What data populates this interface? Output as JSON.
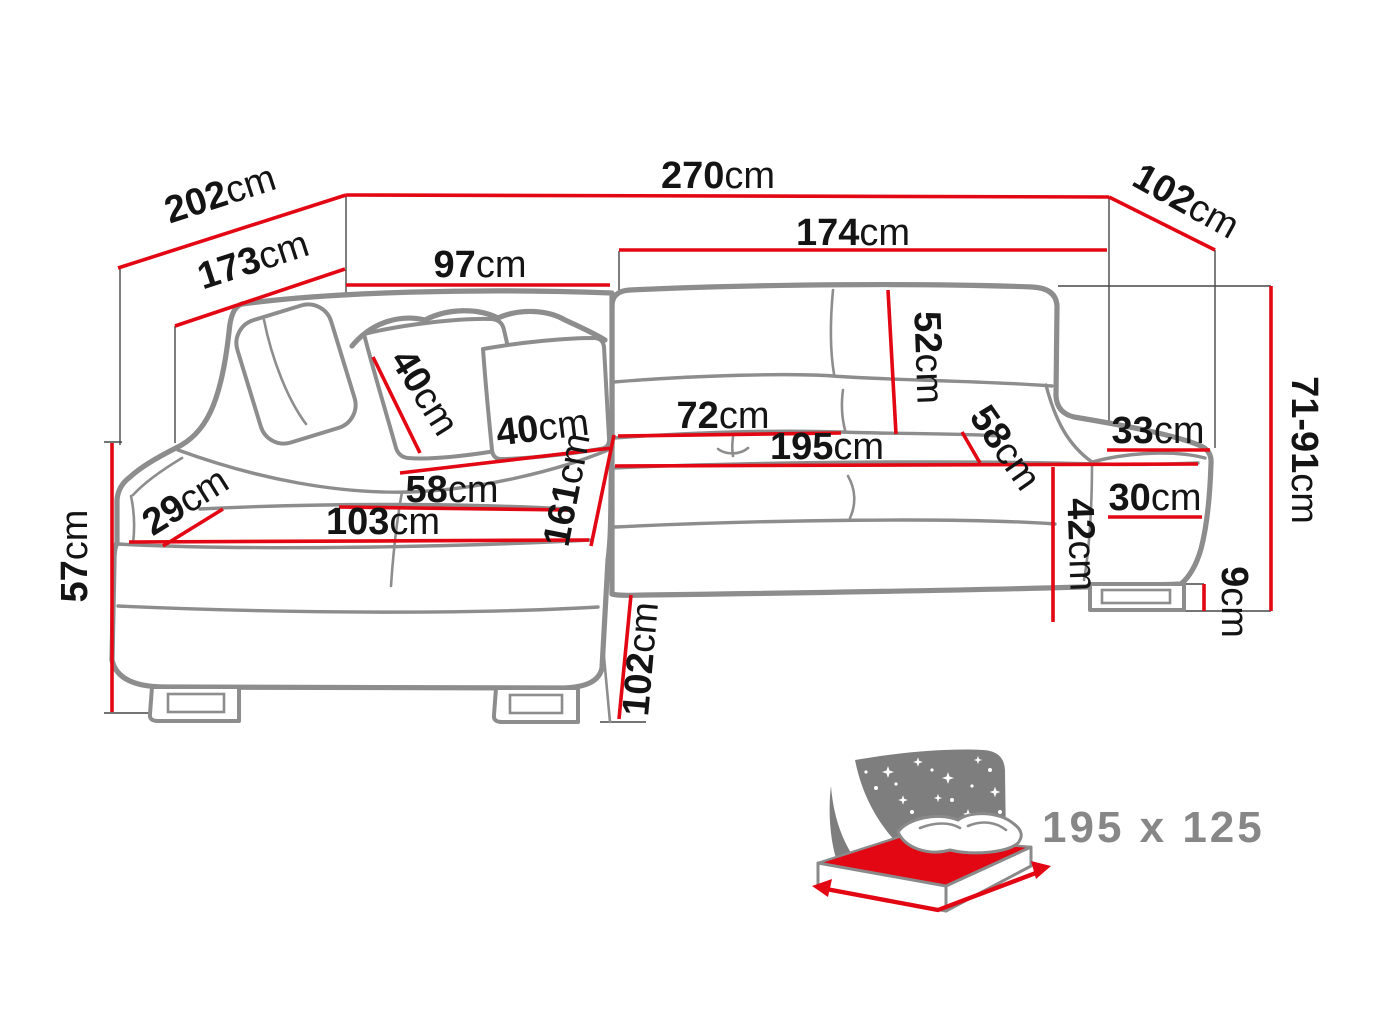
{
  "diagram": {
    "type": "corner-sofa-bed dimension drawing",
    "colors": {
      "dimension_line": "#e30613",
      "sofa_outline": "#8d8d8d",
      "label_text": "#141414",
      "icon_gray": "#7e7e7e",
      "icon_label_gray": "#878787"
    },
    "dims": {
      "d202": {
        "v": "202",
        "u": "cm"
      },
      "d270": {
        "v": "270",
        "u": "cm"
      },
      "d102t": {
        "v": "102",
        "u": "cm"
      },
      "d173": {
        "v": "173",
        "u": "cm"
      },
      "d97": {
        "v": "97",
        "u": "cm"
      },
      "d174": {
        "v": "174",
        "u": "cm"
      },
      "d52": {
        "v": "52",
        "u": "cm"
      },
      "d40a": {
        "v": "40",
        "u": "cm"
      },
      "d40b": {
        "v": "40",
        "u": "cm"
      },
      "d72": {
        "v": "72",
        "u": "cm"
      },
      "d195": {
        "v": "195",
        "u": "cm"
      },
      "d58r": {
        "v": "58",
        "u": "cm"
      },
      "d33": {
        "v": "33",
        "u": "cm"
      },
      "d30": {
        "v": "30",
        "u": "cm"
      },
      "d42": {
        "v": "42",
        "u": "cm"
      },
      "d71_91": {
        "v": "71-91",
        "u": "cm"
      },
      "d9": {
        "v": "9",
        "u": "cm"
      },
      "d58l": {
        "v": "58",
        "u": "cm"
      },
      "d103": {
        "v": "103",
        "u": "cm"
      },
      "d29": {
        "v": "29",
        "u": "cm"
      },
      "d161": {
        "v": "161",
        "u": "cm"
      },
      "d57": {
        "v": "57",
        "u": "cm"
      },
      "d102b": {
        "v": "102",
        "u": "cm"
      }
    },
    "sleeping_area": {
      "label": "195 x 125"
    }
  }
}
